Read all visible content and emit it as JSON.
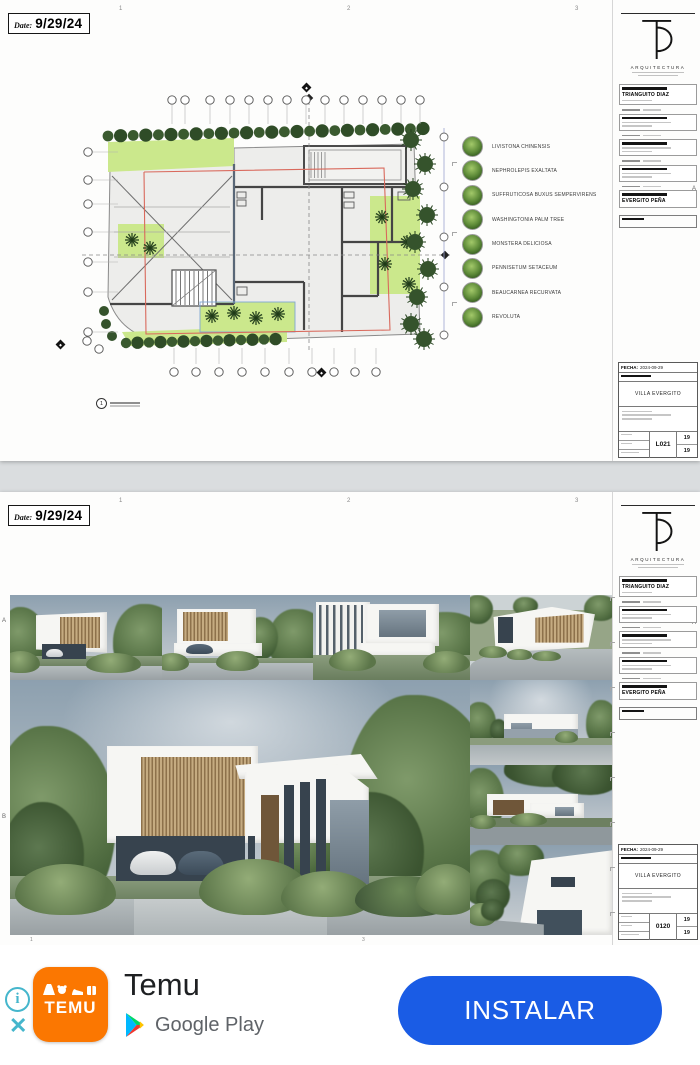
{
  "sheets": {
    "date_label": "Date:",
    "date_value": "9/29/24",
    "grid_top": [
      "1",
      "2",
      "3"
    ],
    "edge_letters": {
      "right": "A",
      "left_a": "A",
      "left_b": "B"
    },
    "firm": {
      "name": "ARQUITECTURA",
      "client_name": "TRIANGUITO DIAZ",
      "builder_name": "EVERGITO PEÑA"
    },
    "titleblock": {
      "fecha_label": "FECHA:",
      "fecha_value": "2024-09-29",
      "project": "VILLA EVERGITO",
      "code_sheet1": "L021",
      "code_sheet2": "0120",
      "num_a": "19",
      "num_b": "19"
    },
    "plan": {
      "callout_number": "1"
    },
    "legend_items": [
      "LIVISTONA CHINENSIS",
      "NEPHROLEPIS EXALTATA",
      "SUFFRUTICOSA BUXUS SEMPERVIRENS",
      "WASHINGTONIA PALM TREE",
      "MONSTERA DELICIOSA",
      "PENNISETUM SETACEUM",
      "BEAUCARNEA RECURVATA",
      "REVOLUTA"
    ],
    "footer_numbers": [
      "1",
      "3"
    ]
  },
  "ad": {
    "app_name": "Temu",
    "store_name": "Google Play",
    "install_label": "INSTALAR",
    "icon_word": "TEMU",
    "info_symbol": "i",
    "close_symbol": "✕",
    "colors": {
      "temu_orange": "#fb7701",
      "install_blue": "#1a5ce5",
      "info_teal": "#45b6cc"
    }
  }
}
